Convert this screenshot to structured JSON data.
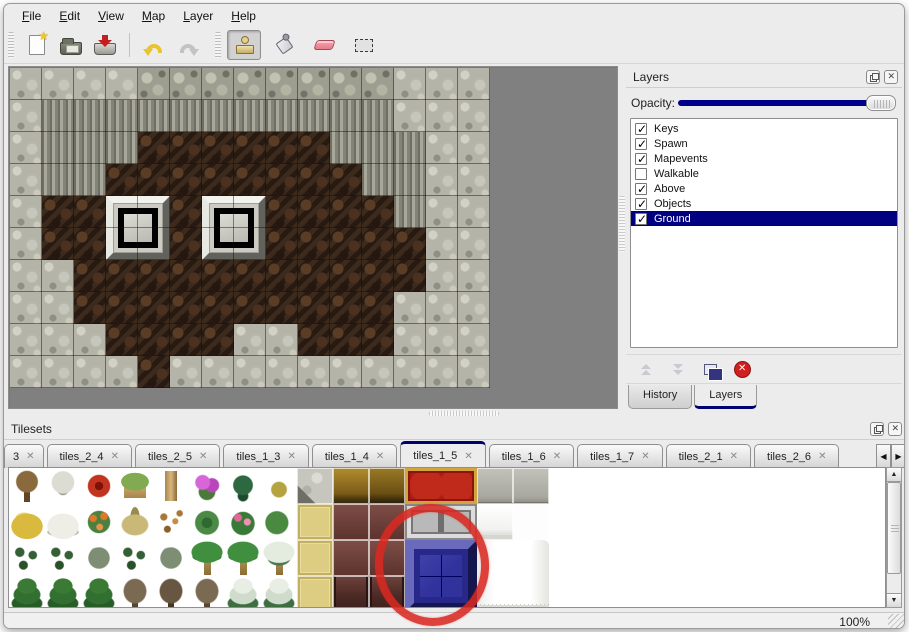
{
  "menu": {
    "items": [
      "File",
      "Edit",
      "View",
      "Map",
      "Layer",
      "Help"
    ]
  },
  "toolbar": {
    "buttons": [
      {
        "name": "new-file",
        "active": false
      },
      {
        "name": "open-file",
        "active": false
      },
      {
        "name": "save-file",
        "active": false
      },
      {
        "name": "undo",
        "active": false
      },
      {
        "name": "redo",
        "active": false
      },
      {
        "name": "stamp-tool",
        "active": true
      },
      {
        "name": "fill-tool",
        "active": false
      },
      {
        "name": "eraser-tool",
        "active": false
      },
      {
        "name": "select-tool",
        "active": false
      }
    ]
  },
  "layers_panel": {
    "title": "Layers",
    "opacity_label": "Opacity:",
    "layers": [
      {
        "name": "Keys",
        "checked": true,
        "selected": false
      },
      {
        "name": "Spawn",
        "checked": true,
        "selected": false
      },
      {
        "name": "Mapevents",
        "checked": true,
        "selected": false
      },
      {
        "name": "Walkable",
        "checked": false,
        "selected": false
      },
      {
        "name": "Above",
        "checked": true,
        "selected": false
      },
      {
        "name": "Objects",
        "checked": true,
        "selected": false
      },
      {
        "name": "Ground",
        "checked": true,
        "selected": true
      }
    ],
    "tabs": [
      {
        "label": "History",
        "active": false
      },
      {
        "label": "Layers",
        "active": true
      }
    ]
  },
  "tilesets_panel": {
    "title": "Tilesets",
    "tabs": [
      {
        "label": "3",
        "active": false,
        "truncated": true
      },
      {
        "label": "tiles_2_4",
        "active": false
      },
      {
        "label": "tiles_2_5",
        "active": false
      },
      {
        "label": "tiles_1_3",
        "active": false
      },
      {
        "label": "tiles_1_4",
        "active": false
      },
      {
        "label": "tiles_1_5",
        "active": true
      },
      {
        "label": "tiles_1_6",
        "active": false
      },
      {
        "label": "tiles_1_7",
        "active": false
      },
      {
        "label": "tiles_2_1",
        "active": false
      },
      {
        "label": "tiles_2_6",
        "active": false
      }
    ]
  },
  "statusbar": {
    "zoom": "100%"
  },
  "icons": {
    "close_x": "✕",
    "arrow_left": "◀",
    "arrow_right": "▶",
    "arrow_up": "▲",
    "arrow_down": "▼"
  },
  "map": {
    "tile_size": 32,
    "legend": {
      "S": "stone-ground",
      "T": "cliff-top",
      "C": "cliff-face",
      "F": "dirt-floor",
      "W": "dirt-floor-under-window"
    },
    "rows": [
      "SSSSTTTTTTTTSSS",
      "SCCCCCCCCCCCSSS",
      "SCCCFFFFFFCCCSS",
      "SCCFFFFFFFFCCSS",
      "SFFWWFWWFFFFCSS",
      "SFFWWFWWFFFFFSS",
      "SSFFFFFFFFFFFSS",
      "SSFFFFFFFFFFSSS",
      "SSSFFFFSSFFFSSS",
      "SSSSFSSSSSSSSSS"
    ],
    "windows": [
      {
        "col": 3,
        "row": 4
      },
      {
        "col": 6,
        "row": 4
      }
    ]
  },
  "tileset_grid": {
    "cell_size": 36,
    "rows": [
      [
        "tree-bare",
        "tree-frost",
        "flower-red",
        "stump",
        "trunk",
        "bush-pink",
        "fern",
        "sprig-yellow",
        "stone-corner",
        "wood-brown",
        "wood-brown2",
        "",
        "",
        "stone-gray",
        "stone-gray"
      ],
      [
        "mound-yellow",
        "mound-snow",
        "flowers-orange",
        "grass-dry",
        "leaves",
        "lilypad",
        "roses-pink",
        "lilypad-curl",
        "floor-gold",
        "table-dark",
        "table-dark",
        "",
        "",
        "curtain-small",
        "blank-white"
      ],
      [
        "sprigs",
        "sprigs",
        "bush-gray",
        "sprigs",
        "bush-gray",
        "palm",
        "palm",
        "palm-snow",
        "floor-gold",
        "table-dark",
        "table-dark",
        "",
        "",
        "",
        ""
      ],
      [
        "pine",
        "pine",
        "pine",
        "tree-dead",
        "tree-dead2",
        "tree-dead",
        "pine-snow",
        "pine-snow",
        "floor-gold",
        "table-leg",
        "table-leg",
        "",
        "",
        "",
        ""
      ]
    ],
    "overlays": [
      {
        "type": "carpet-red",
        "col": 11,
        "row": 0,
        "w": 2,
        "h": 1
      },
      {
        "type": "frame-silver",
        "col": 11,
        "row": 1,
        "w": 2,
        "h": 1
      },
      {
        "type": "blue-tile",
        "col": 11,
        "row": 2,
        "w": 2,
        "h": 2
      },
      {
        "type": "curtain-big",
        "col": 13,
        "row": 2,
        "w": 2,
        "h": 2
      }
    ],
    "annotation": "red-circle-around-blue-tile"
  },
  "colors": {
    "accent_navy": "#000080",
    "selection_bg": "#000080",
    "map_empty_bg": "#808080",
    "annotation_red": "#d82921",
    "panel_bg": "#ececec"
  }
}
